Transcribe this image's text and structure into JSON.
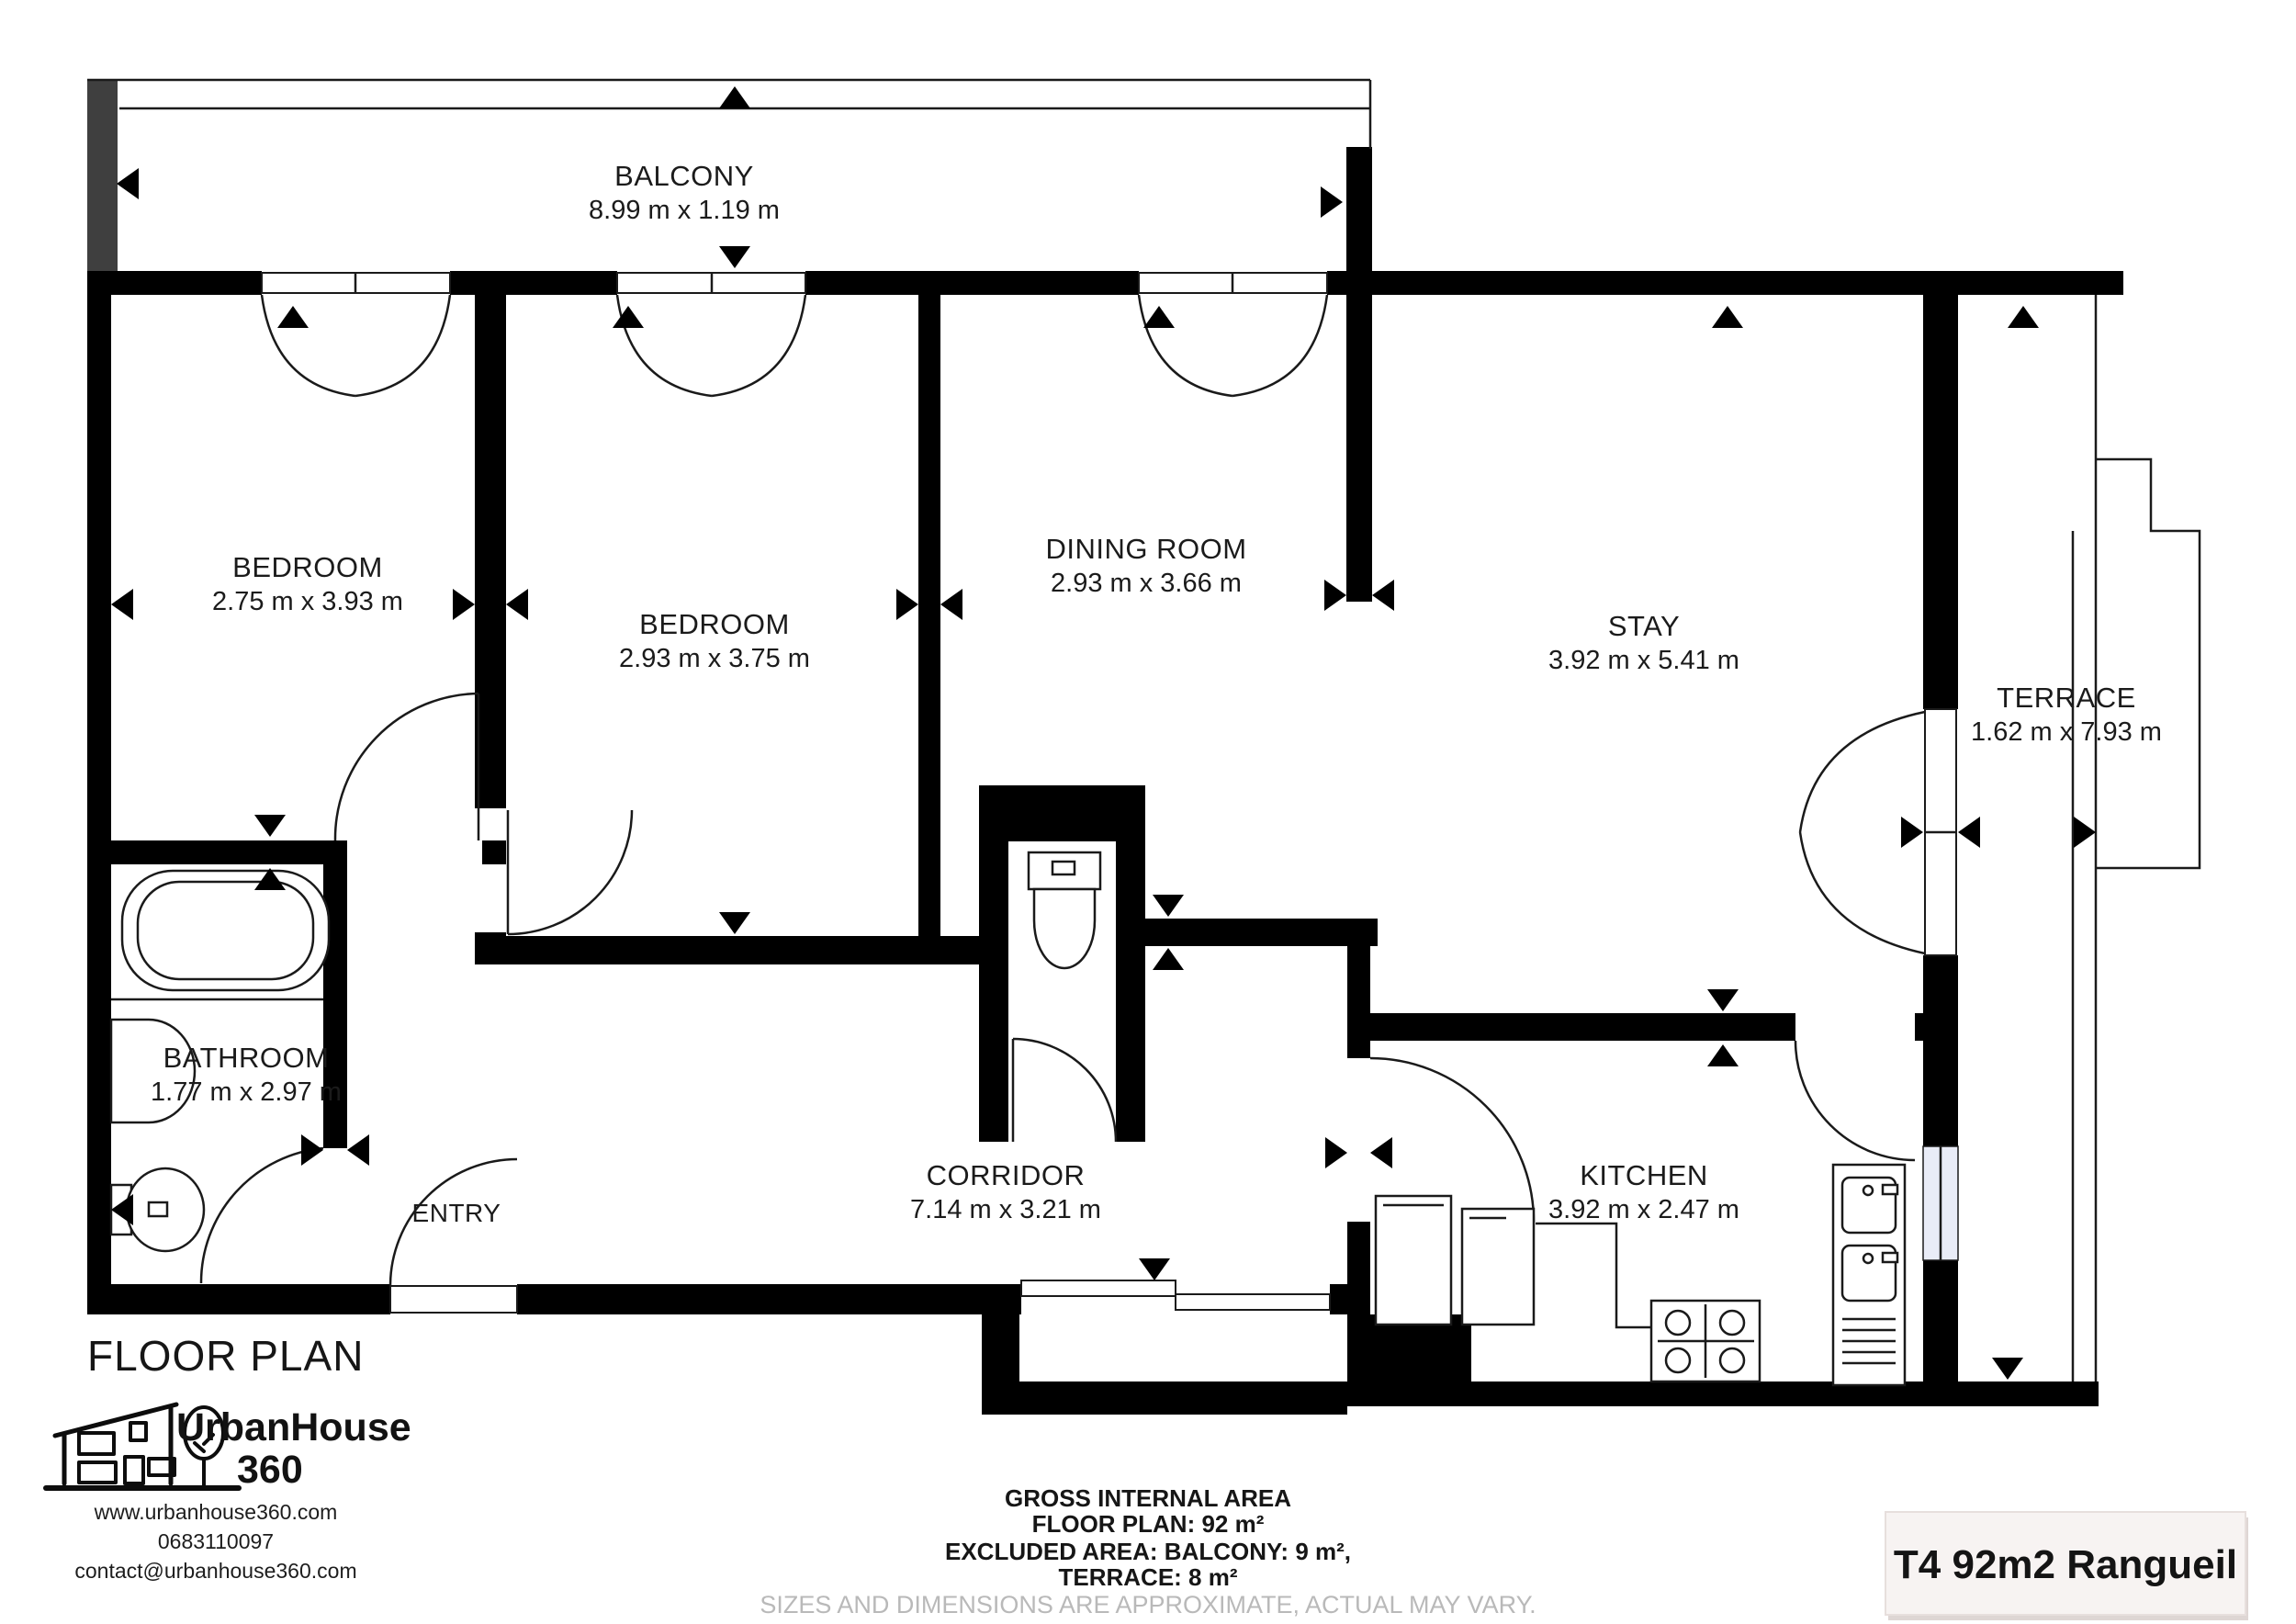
{
  "title": "FLOOR PLAN",
  "colors": {
    "wall": "#000000",
    "balcony_bar": "#3f3f3f",
    "window_glass": "#e9ecf7",
    "disclaimer_gray": "#b9b9b9",
    "badge_bg": "#f7f3f2",
    "badge_border": "#e7dfdd"
  },
  "rooms": [
    {
      "name": "BALCONY",
      "dims": "8.99 m x 1.19 m"
    },
    {
      "name": "BEDROOM",
      "dims": "2.75 m x 3.93 m"
    },
    {
      "name": "BEDROOM",
      "dims": "2.93 m x 3.75 m"
    },
    {
      "name": "DINING ROOM",
      "dims": "2.93 m x 3.66 m"
    },
    {
      "name": "STAY",
      "dims": "3.92 m x 5.41 m"
    },
    {
      "name": "TERRACE",
      "dims": "1.62 m x 7.93 m"
    },
    {
      "name": "BATHROOM",
      "dims": "1.77 m x 2.97 m"
    },
    {
      "name": "CORRIDOR",
      "dims": "7.14 m x 3.21 m"
    },
    {
      "name": "KITCHEN",
      "dims": "3.92 m x 2.47 m"
    },
    {
      "name": "ENTRY",
      "dims": ""
    }
  ],
  "footer": {
    "brand_line1": "UrbanHouse",
    "brand_line2": "360",
    "website": "www.urbanhouse360.com",
    "phone": "0683110097",
    "email": "contact@urbanhouse360.com",
    "area_line1": "GROSS INTERNAL AREA",
    "area_line2": "FLOOR PLAN: 92 m²",
    "area_line3": "EXCLUDED AREA: BALCONY: 9 m²,",
    "area_line4": "TERRACE: 8 m²",
    "disclaimer": "SIZES AND DIMENSIONS ARE APPROXIMATE, ACTUAL MAY VARY.",
    "badge": "T4 92m2 Rangueil"
  }
}
